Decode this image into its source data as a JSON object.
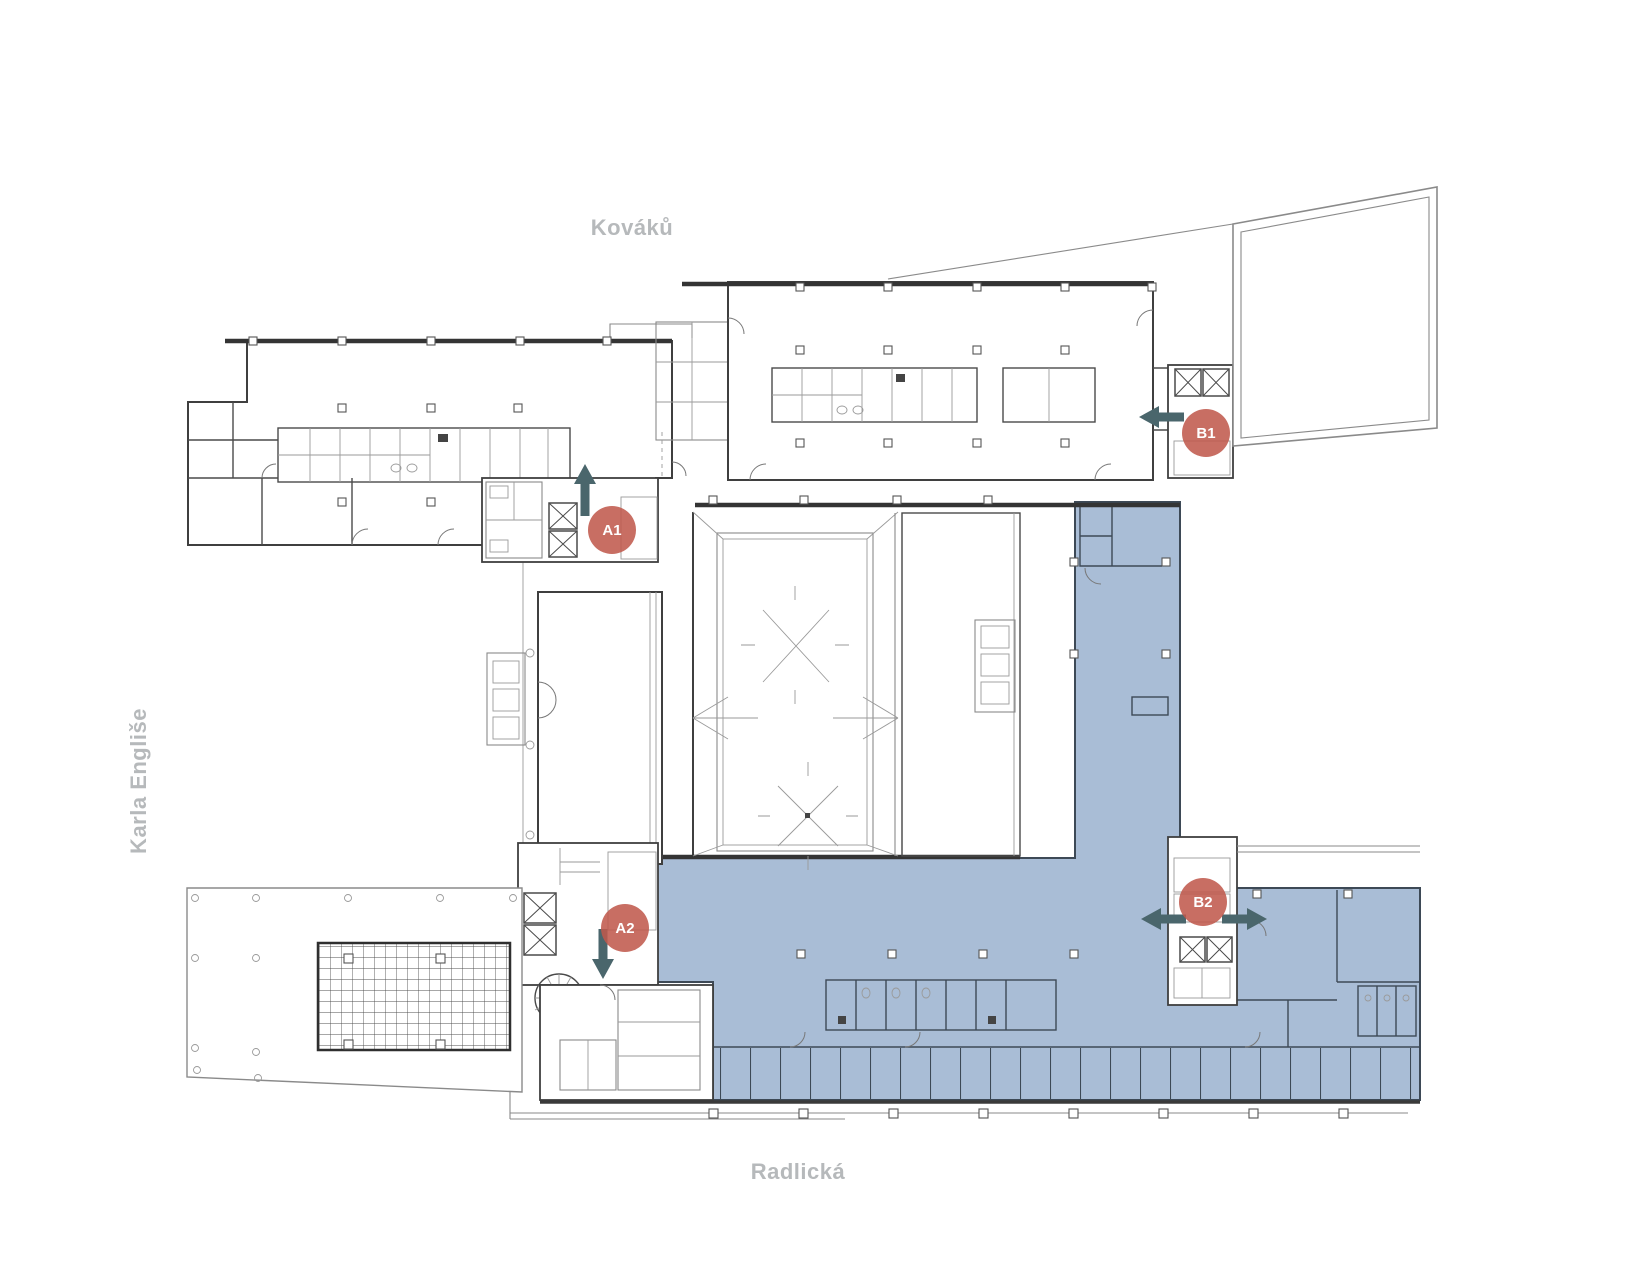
{
  "streets": {
    "top": "Kováků",
    "left": "Karla Engliše",
    "bottom": "Radlická"
  },
  "markers": [
    {
      "label": "A1"
    },
    {
      "label": "A2"
    },
    {
      "label": "B1"
    },
    {
      "label": "B2"
    }
  ],
  "colors": {
    "highlight_fill": "#a9bdd6",
    "marker_fill": "#c0584c",
    "arrow_fill": "#4a666c",
    "street_label": "#b6b9bb",
    "wall": "#3f3f3f"
  }
}
